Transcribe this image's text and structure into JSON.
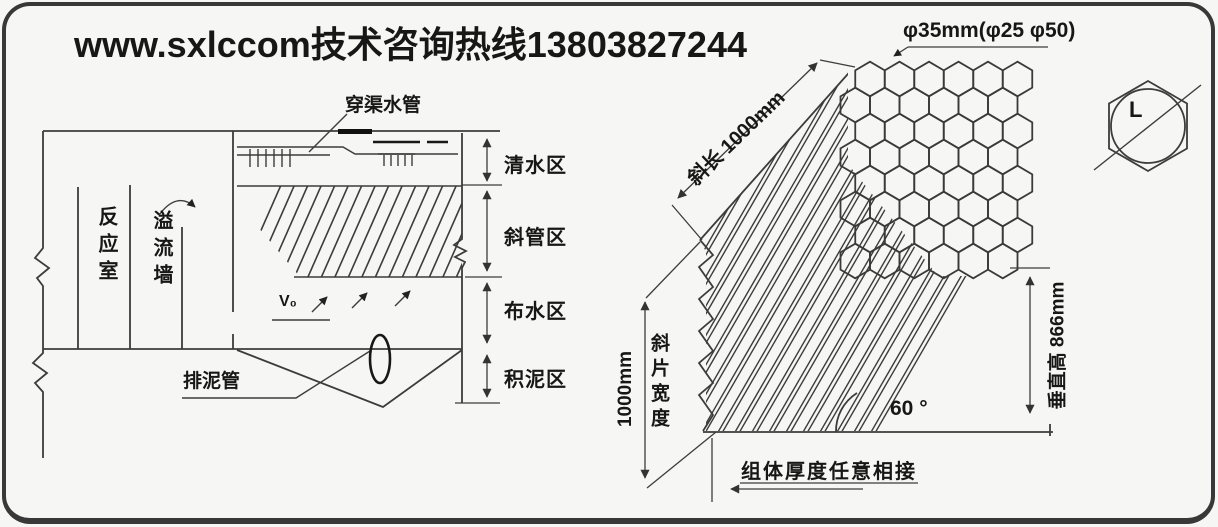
{
  "watermark": "www.sxlccom技术咨询热线13803827244",
  "left_diagram": {
    "pipe_label": "穿渠水管",
    "reaction_chamber": "反应室",
    "overflow_wall": "溢流墙",
    "sludge_pipe_label": "排泥管",
    "velocity_label": "V₀",
    "zones": [
      {
        "label": "清水区"
      },
      {
        "label": "斜管区"
      },
      {
        "label": "布水区"
      },
      {
        "label": "积泥区"
      }
    ]
  },
  "right_diagram": {
    "diameter_label": "φ35mm(φ25 φ50)",
    "slant_length_label": "斜长 1000mm",
    "sheet_width_value": "1000mm",
    "sheet_width_label": "斜片宽度",
    "vertical_height_label": "垂直高 866mm",
    "angle_label": "60 °",
    "module_note": "组体厚度任意相接",
    "hex_detail_letter": "L"
  },
  "colors": {
    "line": "#3c3c3c",
    "text": "#171717",
    "background": "#f6f6f4",
    "border": "#383838"
  }
}
